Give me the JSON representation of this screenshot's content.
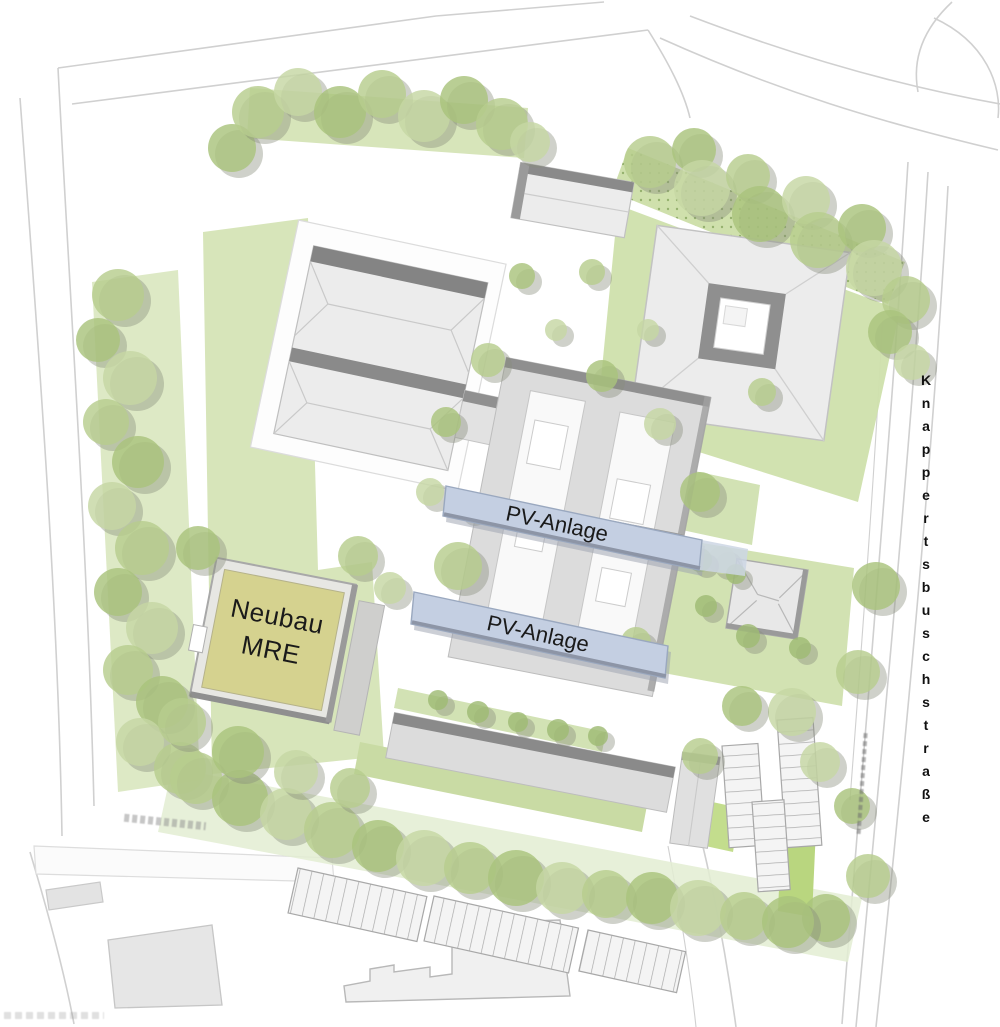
{
  "plan": {
    "labels": {
      "neubau": "Neubau MRE",
      "pv1": "PV-Anlage",
      "pv2": "PV-Anlage",
      "street": "Knappertsbuschstraße"
    },
    "colors": {
      "lawn_light": "#e3edd2",
      "lawn": "#d7e5ba",
      "lawn_bright": "#b9d67f",
      "tree": "#aec983",
      "tree_shadow": "#868b7b",
      "building_fill": "#ececec",
      "building_edge": "#8a8a8a",
      "pv_panel": "#c4cfe2",
      "neubau_fill": "#d5d28f",
      "road_line": "#d0d0d0",
      "text": "#1a1a1a"
    }
  }
}
